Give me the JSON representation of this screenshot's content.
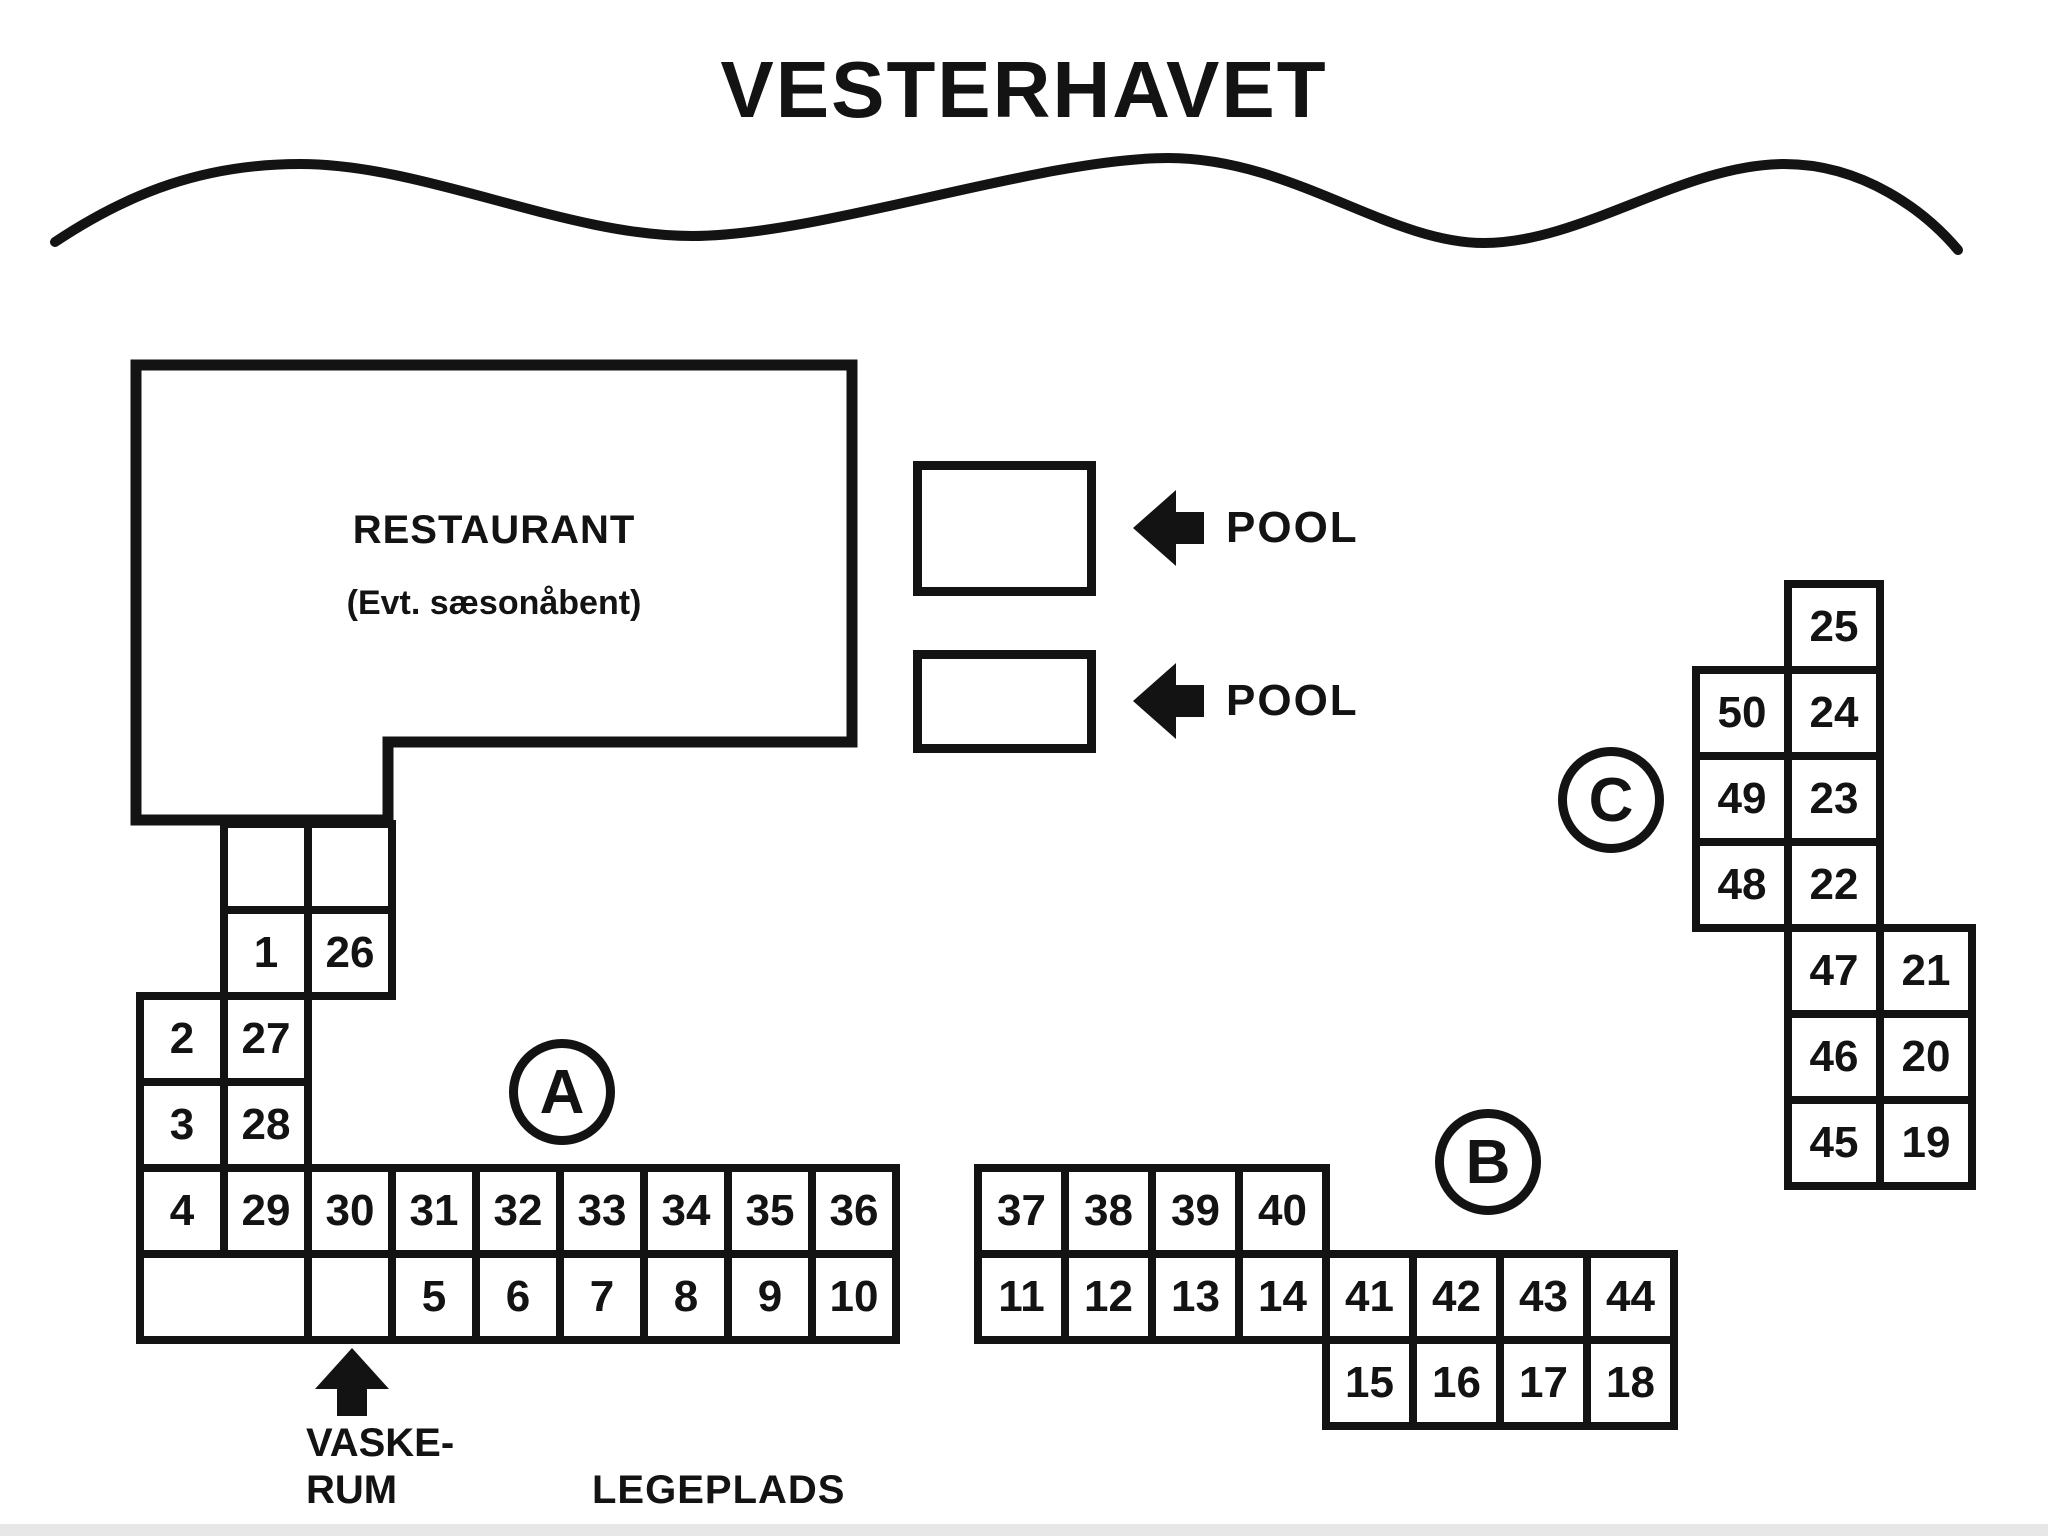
{
  "title": "VESTERHAVET",
  "colors": {
    "ink": "#131313",
    "background": "#ffffff",
    "bottom_strip": "#e7e7e7"
  },
  "restaurant": {
    "name": "RESTAURANT",
    "note": "(Evt. sæsonåbent)"
  },
  "pools": [
    "POOL",
    "POOL"
  ],
  "labels": {
    "laundry_line1": "VASKE-",
    "laundry_line2": "RUM",
    "playground": "LEGEPLADS"
  },
  "sections": {
    "a": {
      "circle": "A",
      "cells": [
        {
          "label": "",
          "col": 1,
          "row": 0
        },
        {
          "label": "",
          "col": 2,
          "row": 0
        },
        {
          "label": "1",
          "col": 1,
          "row": 1
        },
        {
          "label": "26",
          "col": 2,
          "row": 1
        },
        {
          "label": "2",
          "col": 0,
          "row": 2
        },
        {
          "label": "27",
          "col": 1,
          "row": 2
        },
        {
          "label": "3",
          "col": 0,
          "row": 3
        },
        {
          "label": "28",
          "col": 1,
          "row": 3
        },
        {
          "label": "4",
          "col": 0,
          "row": 4
        },
        {
          "label": "29",
          "col": 1,
          "row": 4
        },
        {
          "label": "30",
          "col": 2,
          "row": 4
        },
        {
          "label": "31",
          "col": 3,
          "row": 4
        },
        {
          "label": "32",
          "col": 4,
          "row": 4
        },
        {
          "label": "33",
          "col": 5,
          "row": 4
        },
        {
          "label": "34",
          "col": 6,
          "row": 4
        },
        {
          "label": "35",
          "col": 7,
          "row": 4
        },
        {
          "label": "36",
          "col": 8,
          "row": 4
        },
        {
          "label": "",
          "col": 0,
          "row": 5,
          "span": 2
        },
        {
          "label": "",
          "col": 2,
          "row": 5
        },
        {
          "label": "5",
          "col": 3,
          "row": 5
        },
        {
          "label": "6",
          "col": 4,
          "row": 5
        },
        {
          "label": "7",
          "col": 5,
          "row": 5
        },
        {
          "label": "8",
          "col": 6,
          "row": 5
        },
        {
          "label": "9",
          "col": 7,
          "row": 5
        },
        {
          "label": "10",
          "col": 8,
          "row": 5
        }
      ]
    },
    "b": {
      "circle": "B",
      "cells": [
        {
          "label": "37",
          "col": 0,
          "row": 0
        },
        {
          "label": "38",
          "col": 1,
          "row": 0
        },
        {
          "label": "39",
          "col": 2,
          "row": 0
        },
        {
          "label": "40",
          "col": 3,
          "row": 0
        },
        {
          "label": "11",
          "col": 0,
          "row": 1
        },
        {
          "label": "12",
          "col": 1,
          "row": 1
        },
        {
          "label": "13",
          "col": 2,
          "row": 1
        },
        {
          "label": "14",
          "col": 3,
          "row": 1
        },
        {
          "label": "41",
          "col": 4,
          "row": 1
        },
        {
          "label": "42",
          "col": 5,
          "row": 1
        },
        {
          "label": "43",
          "col": 6,
          "row": 1
        },
        {
          "label": "44",
          "col": 7,
          "row": 1
        },
        {
          "label": "15",
          "col": 4,
          "row": 2
        },
        {
          "label": "16",
          "col": 5,
          "row": 2
        },
        {
          "label": "17",
          "col": 6,
          "row": 2
        },
        {
          "label": "18",
          "col": 7,
          "row": 2
        }
      ]
    },
    "c": {
      "circle": "C",
      "cells": [
        {
          "label": "25",
          "col": 1,
          "row": 0
        },
        {
          "label": "50",
          "col": 0,
          "row": 1
        },
        {
          "label": "24",
          "col": 1,
          "row": 1
        },
        {
          "label": "49",
          "col": 0,
          "row": 2
        },
        {
          "label": "23",
          "col": 1,
          "row": 2
        },
        {
          "label": "48",
          "col": 0,
          "row": 3
        },
        {
          "label": "22",
          "col": 1,
          "row": 3
        },
        {
          "label": "47",
          "col": 1,
          "row": 4
        },
        {
          "label": "21",
          "col": 2,
          "row": 4
        },
        {
          "label": "46",
          "col": 1,
          "row": 5
        },
        {
          "label": "20",
          "col": 2,
          "row": 5
        },
        {
          "label": "45",
          "col": 1,
          "row": 6
        },
        {
          "label": "19",
          "col": 2,
          "row": 6
        }
      ]
    }
  }
}
